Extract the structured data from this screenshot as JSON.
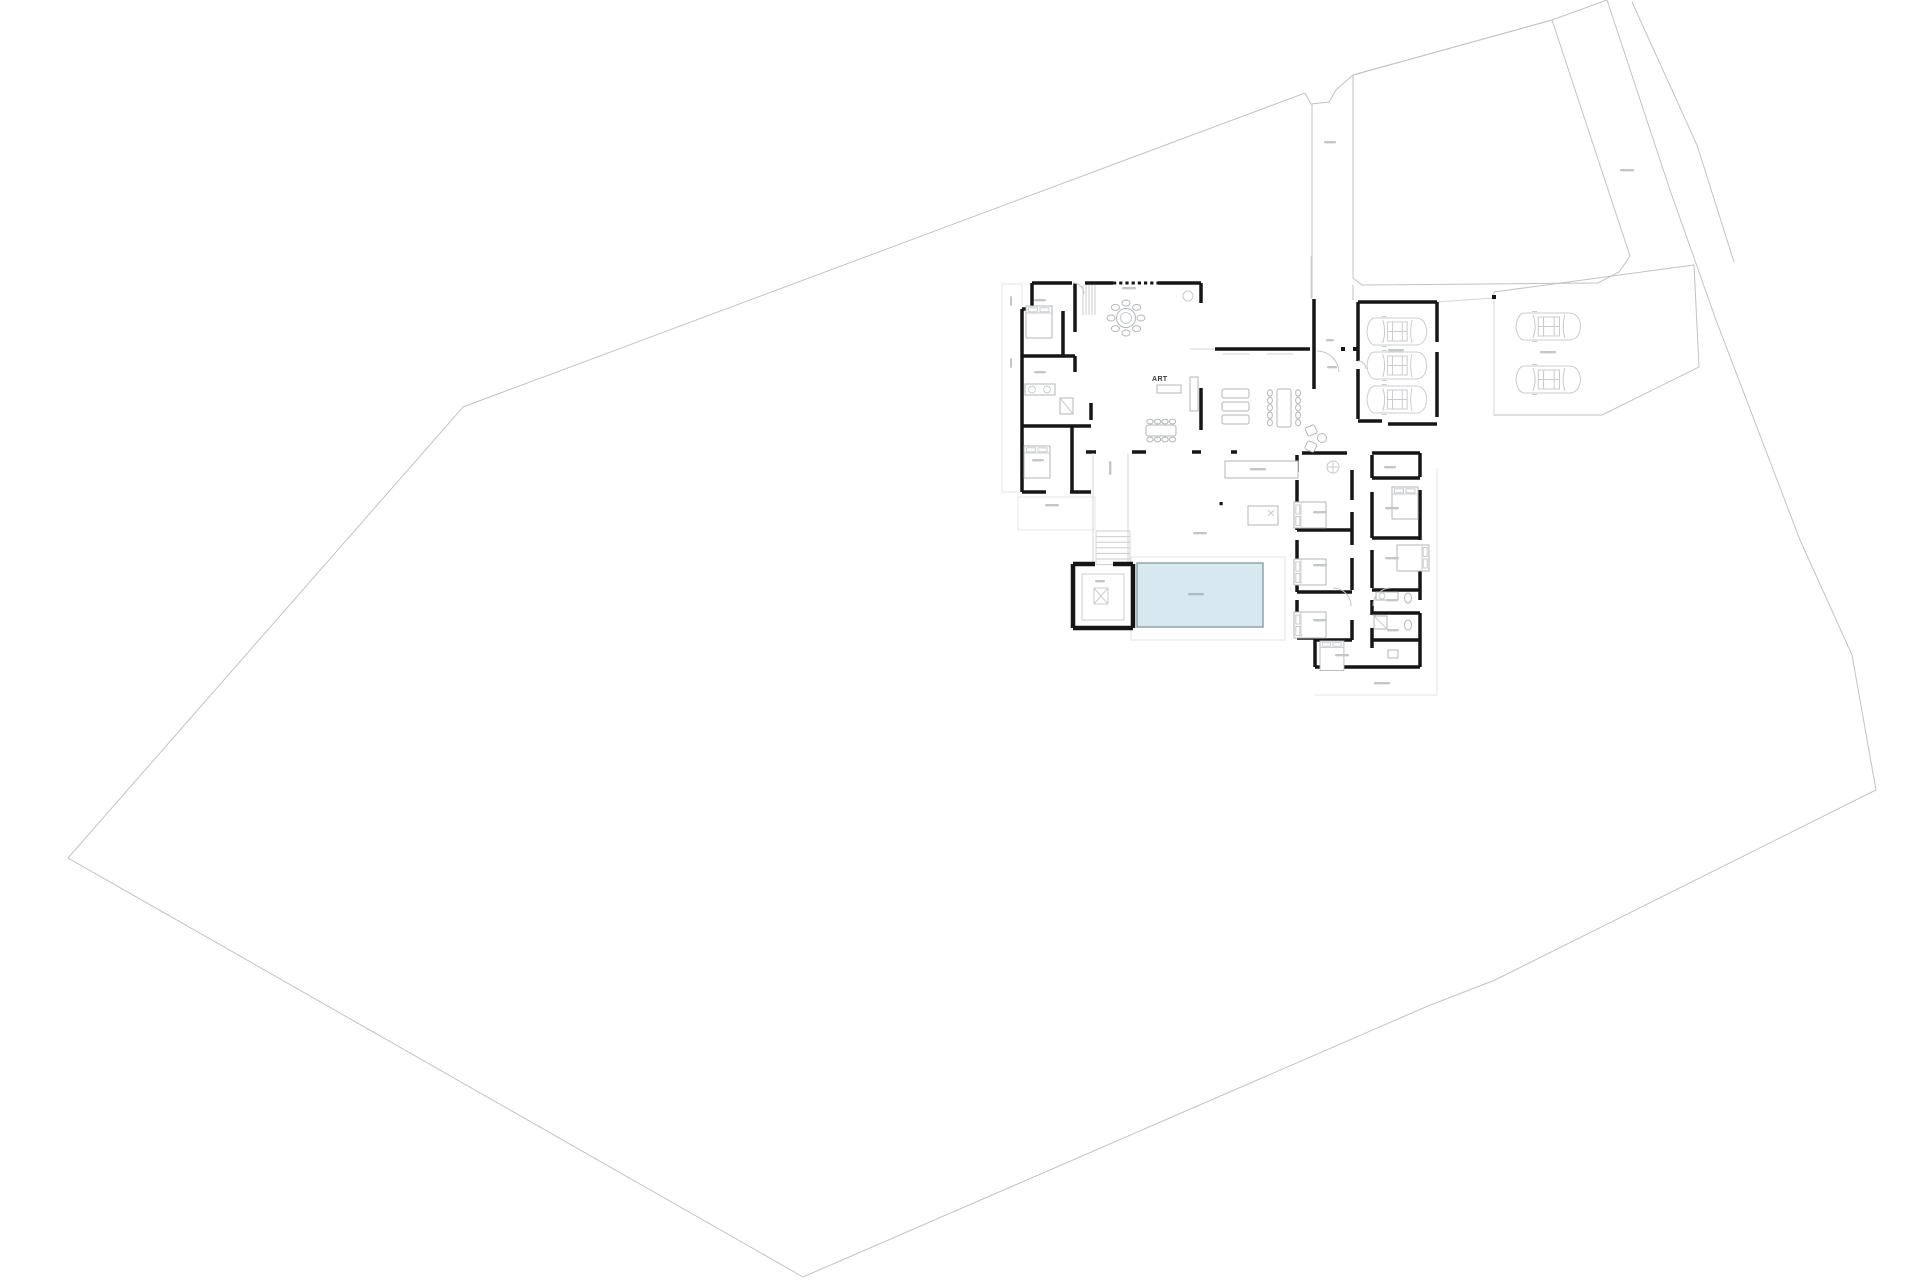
{
  "drawing": {
    "art_label": "ART"
  },
  "colors": {
    "background": "#ffffff",
    "wall": "#161616",
    "boundary": "#c2c2c2",
    "furniture": "#b2b6ba",
    "pool_fill": "#d7e8f0",
    "pool_stroke": "#93a2ab",
    "label_smudge": "#c4c7c9"
  },
  "elements": {
    "garage_cars": 3,
    "guest_parking_cars": 2,
    "pools": 1,
    "spa_rooms": 1,
    "beds_visible": 8,
    "staircases": 1,
    "illegible_small_labels": 27
  }
}
